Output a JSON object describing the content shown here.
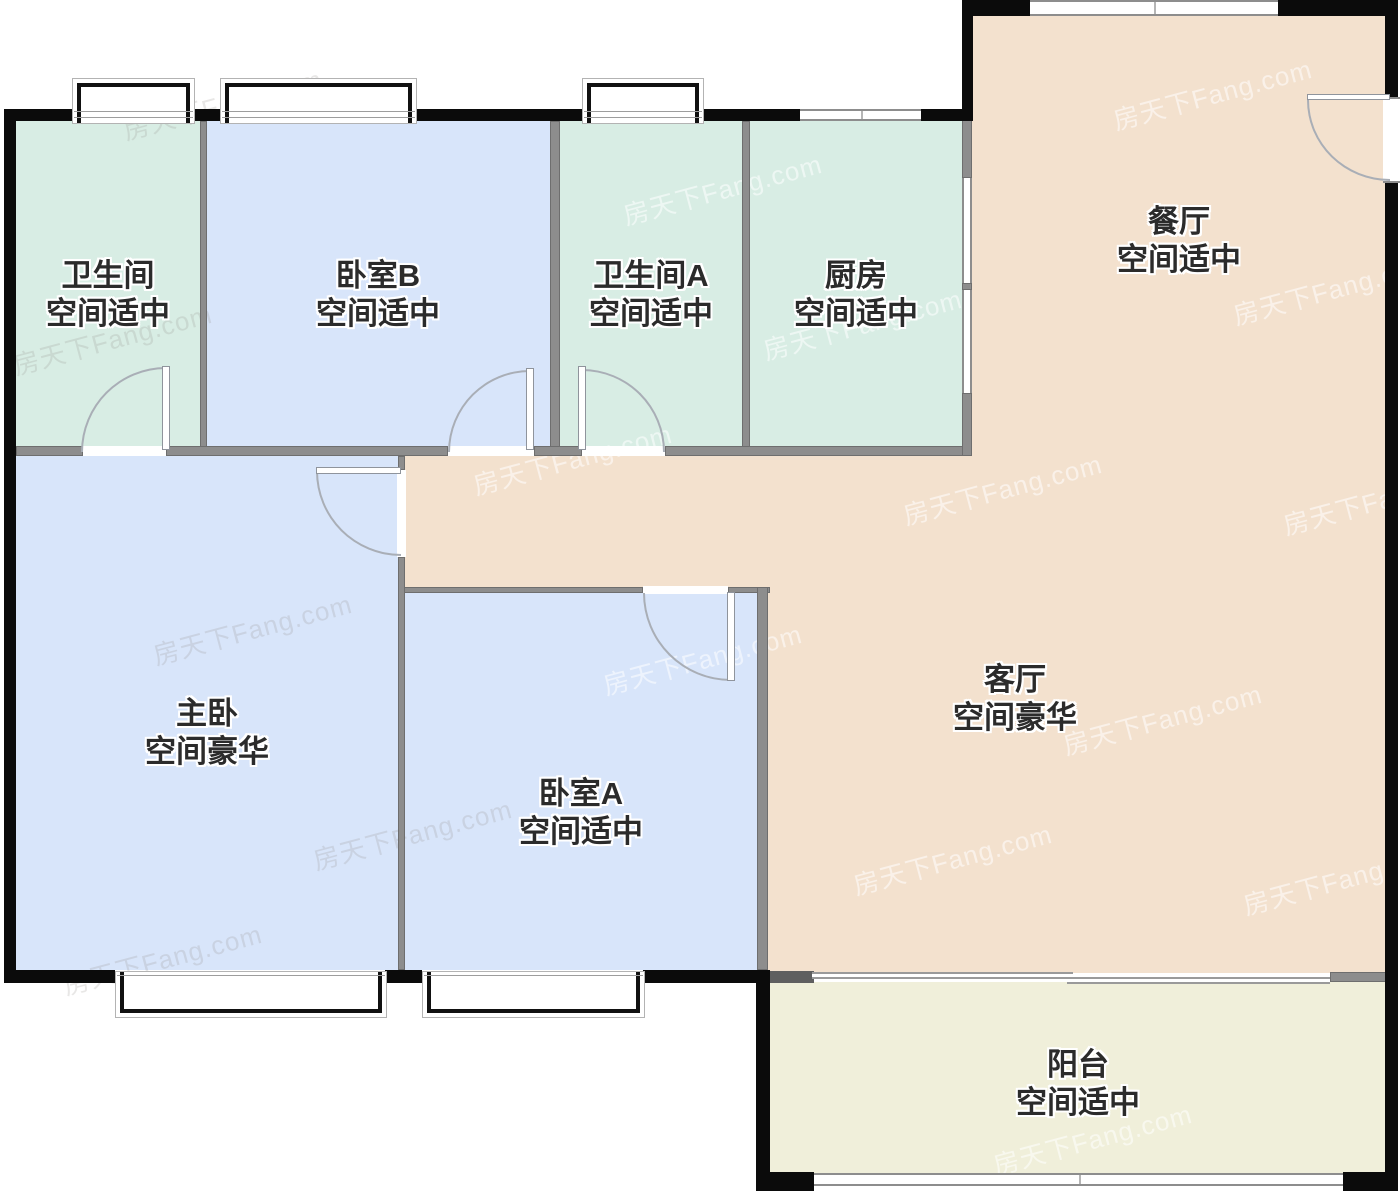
{
  "plan": {
    "watermark": "房天下Fang.com",
    "rooms": [
      {
        "id": "bathroom",
        "name": "卫生间",
        "grade": "空间适中"
      },
      {
        "id": "bedroom-b",
        "name": "卧室B",
        "grade": "空间适中"
      },
      {
        "id": "bathroom-a",
        "name": "卫生间A",
        "grade": "空间适中"
      },
      {
        "id": "kitchen",
        "name": "厨房",
        "grade": "空间适中"
      },
      {
        "id": "dining-room",
        "name": "餐厅",
        "grade": "空间适中"
      },
      {
        "id": "master-bedroom",
        "name": "主卧",
        "grade": "空间豪华"
      },
      {
        "id": "bedroom-a",
        "name": "卧室A",
        "grade": "空间适中"
      },
      {
        "id": "living-room",
        "name": "客厅",
        "grade": "空间豪华"
      },
      {
        "id": "balcony",
        "name": "阳台",
        "grade": "空间适中"
      }
    ],
    "colors": {
      "bedroom_fill": "#d8e5fa",
      "bath_kitchen_fill": "#d8ede4",
      "living_dining_fill": "#f3e1ce",
      "balcony_fill": "#f0efda",
      "outer_wall": "#0b0b0b",
      "inner_wall": "#8d8d8d"
    }
  }
}
